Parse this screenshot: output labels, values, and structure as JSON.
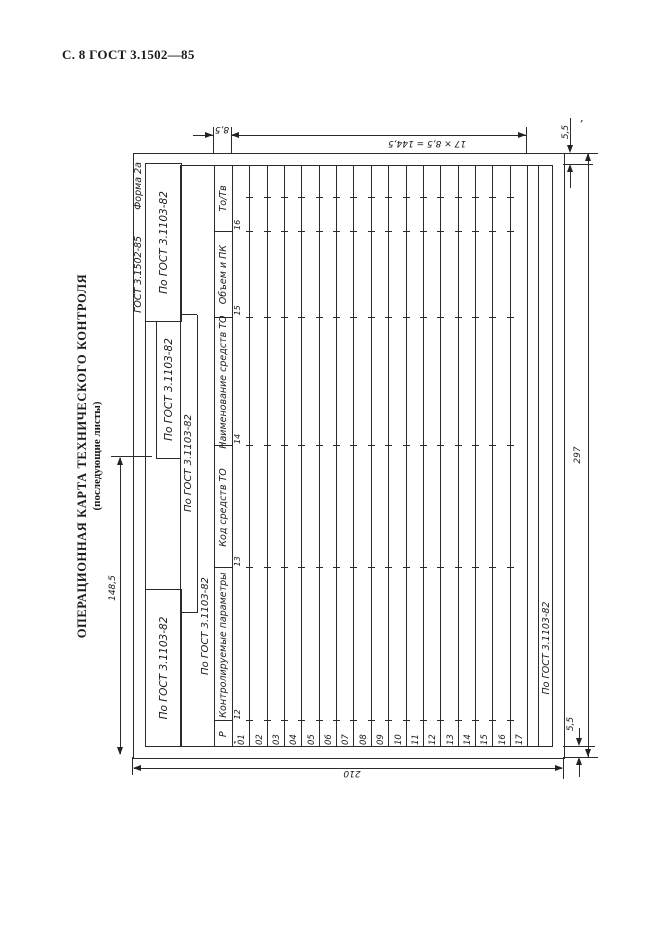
{
  "page": {
    "header_text": "С. 8 ГОСТ 3.1502—85"
  },
  "title": {
    "main": "ОПЕРАЦИОННАЯ КАРТА ТЕХНИЧЕСКОГО КОНТРОЛЯ",
    "subtitle": "(последующие листы)"
  },
  "form": {
    "designation": {
      "standard": "ГОСТ 3.1502-85",
      "form_label": "Форма 2а"
    },
    "blocks": {
      "top_left": "По ГОСТ 3.1103-82",
      "top_middle": "По ГОСТ 3.1103-82",
      "top_right": "По ГОСТ 3.1103-82",
      "strip_row2": "По ГОСТ 3.1103-82",
      "strip_row3": "По ГОСТ 3.1103-82",
      "footer": "По ГОСТ 3.1103-82"
    },
    "table": {
      "columns": [
        {
          "label": "Р",
          "num": "1"
        },
        {
          "label": "Контролируемые параметры",
          "num": "12"
        },
        {
          "label": "Код средств ТО",
          "num": "13"
        },
        {
          "label": "Наименование средств ТО",
          "num": "14"
        },
        {
          "label": "Объем и ПК",
          "num": "15"
        },
        {
          "label": "То/Тв",
          "num": "16"
        }
      ],
      "row_numbers": [
        "01",
        "02",
        "03",
        "04",
        "05",
        "06",
        "07",
        "08",
        "09",
        "10",
        "11",
        "12",
        "13",
        "14",
        "15",
        "16",
        "17"
      ]
    }
  },
  "dimensions": {
    "header_row_height": "8,5",
    "table_rows_formula": "17 × 8,5 = 144,5",
    "margin_top_right": "5,5",
    "sheet_length": "297",
    "margin_bottom_right": "5,5",
    "sheet_width": "210",
    "half_length": "148,5"
  },
  "line_color": "#2b2b2b"
}
